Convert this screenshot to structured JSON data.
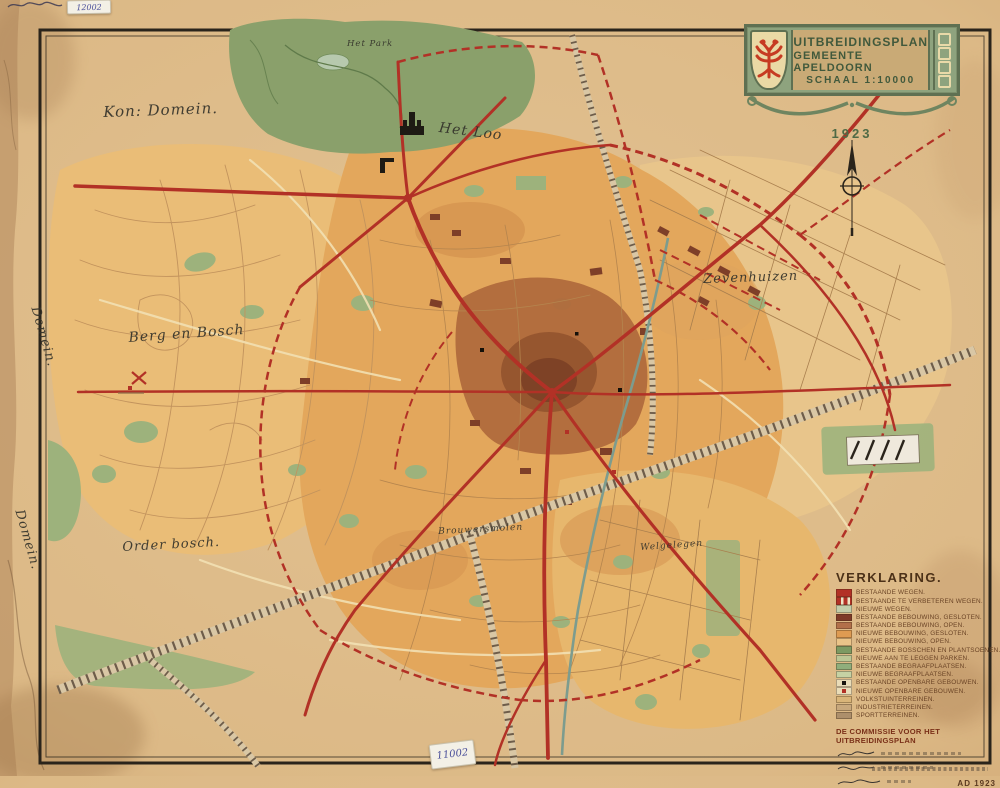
{
  "cartouche": {
    "title_line1": "UITBREIDINGSPLAN",
    "title_line2": "GEMEENTE APELDOORN",
    "title_line3": "SCHAAL 1:10000",
    "year": "1923",
    "coat_of_arms_icon": "apeldoorn-double-eagle-icon"
  },
  "labels": {
    "kon_domein": "Kon: Domein.",
    "het_park": "Het Park",
    "het_loo": "Het Loo",
    "zevenhuizen": "Zevenhuizen",
    "berg_en_bosch": "Berg en Bosch",
    "order_bosch": "Order bosch.",
    "brouwersmolen": "Brouwersmolen",
    "welgelegen": "Welgelegen",
    "domein_vertical_1": "Domein.",
    "domein_vertical_2": "Domein."
  },
  "stickers": {
    "top_left_number": "12002",
    "bottom_number": "11002"
  },
  "legend": {
    "title": "VERKLARING.",
    "items": [
      {
        "label": "Bestaande wegen.",
        "color": "#b23126",
        "variant": "solid"
      },
      {
        "label": "Bestaande te verbeteren wegen.",
        "color": "#b23126",
        "variant": "dashed"
      },
      {
        "label": "Nieuwe wegen.",
        "color": "#c3cdaa",
        "variant": "solid"
      },
      {
        "label": "Bestaande bebouwing, gesloten.",
        "color": "#7e3a28",
        "variant": "solid"
      },
      {
        "label": "Bestaande bebouwing, open.",
        "color": "#b2704a",
        "variant": "solid"
      },
      {
        "label": "Nieuwe bebouwing, gesloten.",
        "color": "#de9b52",
        "variant": "solid"
      },
      {
        "label": "Nieuwe bebouwing, open.",
        "color": "#eac489",
        "variant": "solid"
      },
      {
        "label": "Bestaande bosschen en plantsoenen.",
        "color": "#7d9a62",
        "variant": "solid"
      },
      {
        "label": "Nieuwe aan te leggen parken.",
        "color": "#bcc795",
        "variant": "solid"
      },
      {
        "label": "Bestaande begraafplaatsen.",
        "color": "#8fae7c",
        "variant": "solid"
      },
      {
        "label": "Nieuwe begraafplaatsen.",
        "color": "#c6d2a4",
        "variant": "solid"
      },
      {
        "label": "Bestaande openbare gebouwen.",
        "color": "#e9dcb8",
        "variant": "black-square"
      },
      {
        "label": "Nieuwe openbare gebouwen.",
        "color": "#e9dcb8",
        "variant": "red-square"
      },
      {
        "label": "Volkstuinterreinen.",
        "color": "#d9b579",
        "variant": "solid"
      },
      {
        "label": "Industrieterreinen.",
        "color": "#c8a87c",
        "variant": "solid"
      },
      {
        "label": "Sportterreinen.",
        "color": "#ad8f6b",
        "variant": "solid"
      }
    ],
    "commission_heading": "DE COMMISSIE VOOR HET UITBREIDINGSPLAN",
    "dated": "AD 1923"
  },
  "icons": {
    "north_indicator": "north-arrow-compass-icon",
    "palace": "palace-het-loo-icon",
    "transmitter": "radio-tower-icon"
  },
  "colors": {
    "paper": "#dcb986",
    "frame": "#2a241b",
    "road_red": "#b23126",
    "forest_green": "#8aa06b",
    "park_green": "#9db27c",
    "built_open_orange": "#e3a75c",
    "built_closed_brown": "#7e4226",
    "railway": "#6e5d4a",
    "canal": "#7d9c8e",
    "cartouche_green": "#8ea37e",
    "eagle_red": "#c63b22"
  }
}
